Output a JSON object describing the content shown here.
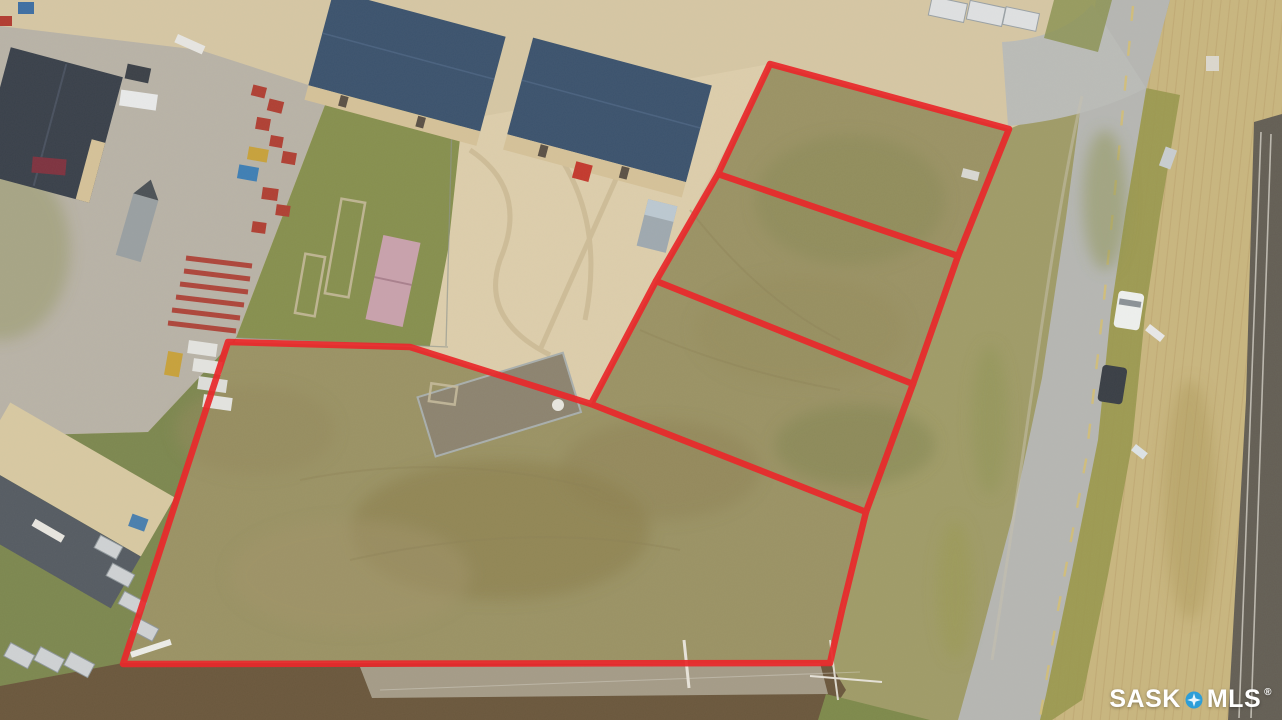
{
  "watermark": {
    "brand_left": "SASK",
    "brand_right": "MLS",
    "registered_mark": "®",
    "icon": "mls-compass-star-icon",
    "icon_color": "#2D9ED8",
    "text_color": "#FFFFFF"
  },
  "annotation": {
    "type": "property-boundary-overlay",
    "lot_count": 4,
    "boundary_color": "#E8292B",
    "perimeter_points": "770,64 1009,129 958,256 913,384 866,512 842,610 830,663 123,664 228,342 410,347 591,404 656,281 718,174",
    "divider_1_points": "718,174 958,256",
    "divider_2_points": "656,281 913,384",
    "divider_3_points": "591,404 866,512"
  },
  "palette": {
    "sand": "#D6C7A4",
    "pale_yard": "#DDCEAC",
    "concrete": "#B9B3A7",
    "grass_lot": "#9B9365",
    "grass_green": "#87904F",
    "ditch_green": "#A09C68",
    "road": "#B6B7B3",
    "field": "#C9B67F",
    "railway": "#645F55",
    "scrub": "#6B583D",
    "gravel": "#A59C88",
    "roof_navy": "#3C536E",
    "roof_charcoal": "#3A414B",
    "roof_tan": "#D8C9A2",
    "roof_dark_gray": "#565C63",
    "wall_tan": "#D5C299",
    "container_pink": "#C9A2AD",
    "container_gray": "#9FA9B0"
  }
}
